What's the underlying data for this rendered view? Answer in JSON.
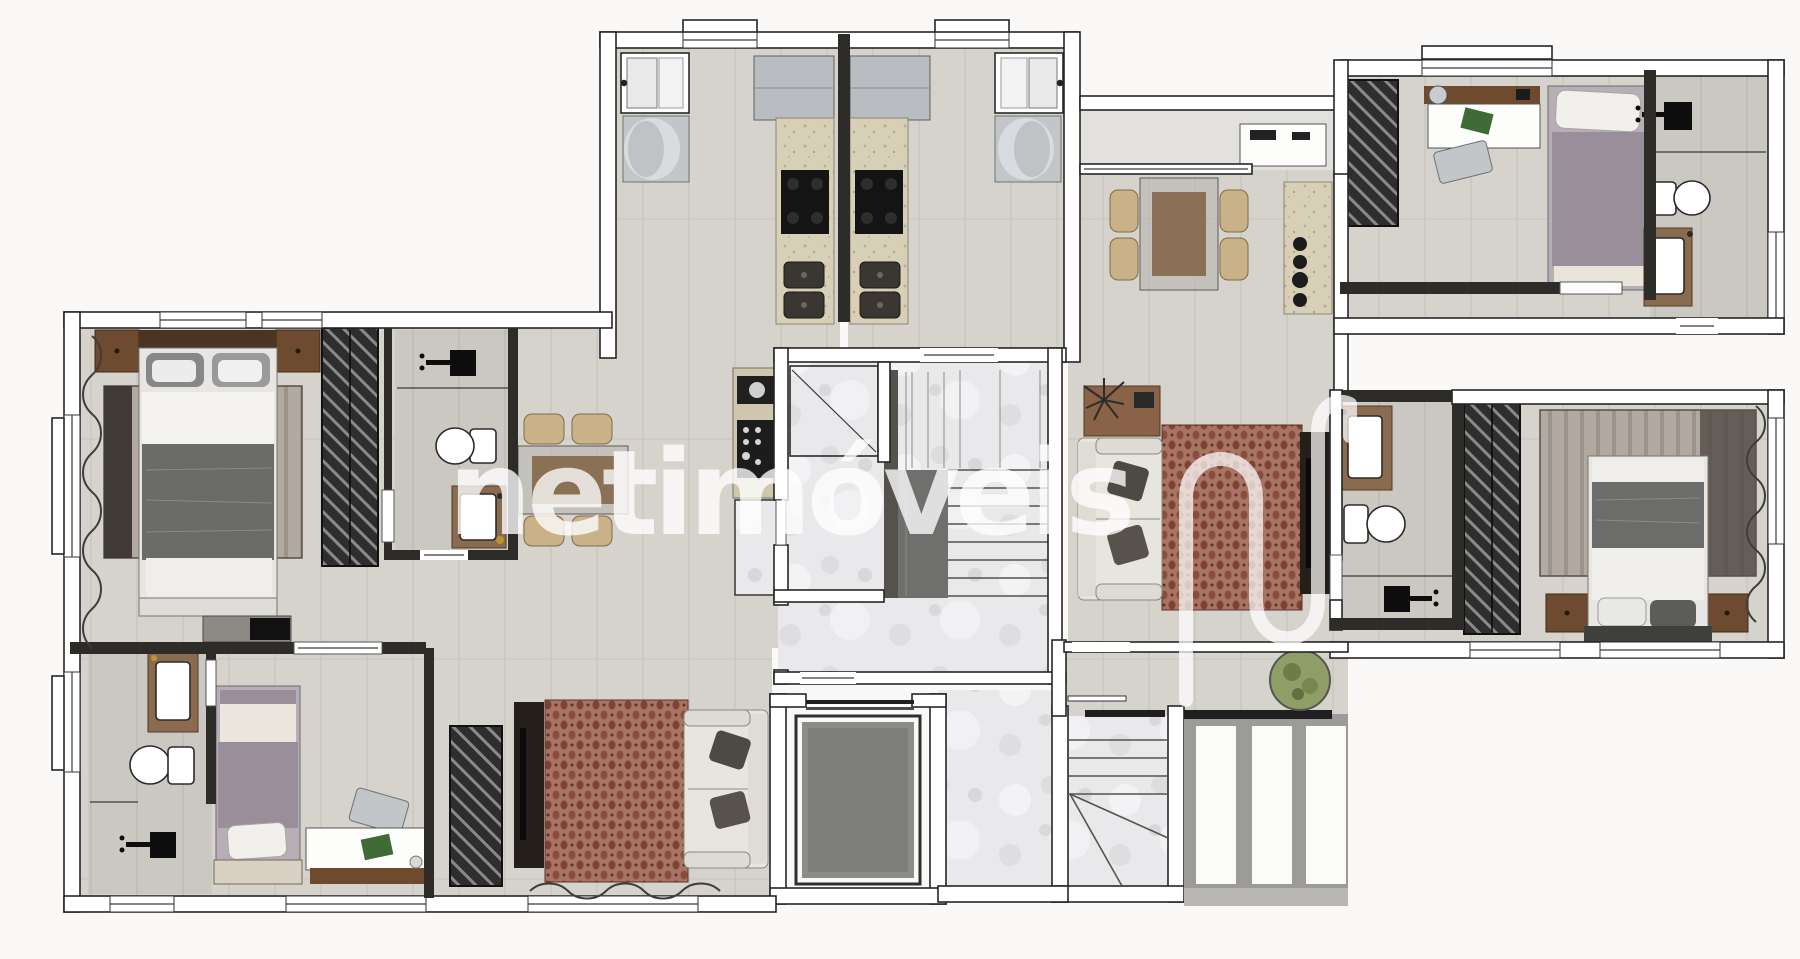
{
  "image_kind": "apartment-floor-plan-render",
  "watermark": {
    "text": "netimóveis",
    "logo": "netimoveis-n-logo",
    "text_color": "rgba(255,255,255,0.78)"
  },
  "palette": {
    "background": "#faf9f7",
    "floor_gray": "#d6d3cd",
    "bath_floor_gray": "#ccc9c3",
    "marble_white": "#e9e9eb",
    "wall_white": "#ffffff",
    "wall_stroke": "#262626",
    "inner_wall": "#2e2c29",
    "counter_beige": "#d8cfb4",
    "rug_red": "#a26b5b",
    "rug_red_dot": "#7c4335",
    "rug_stripe": "#aba399",
    "wardrobe_dark": "#2e2e2e",
    "wood_brown": "#6e4b2e",
    "chair_beige": "#c9b287",
    "bed_blanket_gray": "#6c6c6a",
    "bed_purple": "#9a8e9b",
    "elevator_cab_gray": "#8c8c8a",
    "plant_green": "#8f9e66"
  }
}
